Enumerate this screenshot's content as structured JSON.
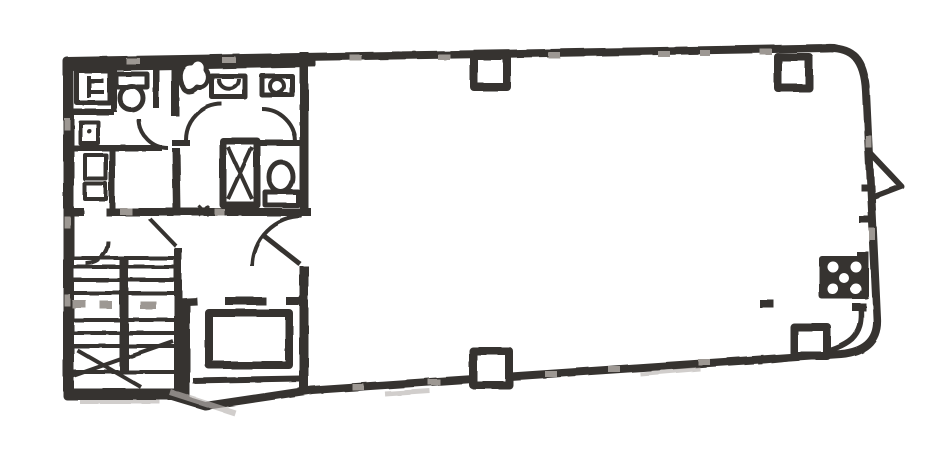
{
  "document": {
    "kind": "scanned architectural floor plan",
    "aria_label": "Scanned building floor plan drawing"
  },
  "colors": {
    "paper": "#ffffff",
    "ink": "#3b3835",
    "ink-soft": "#6b6661",
    "tick": "#9b9692",
    "smudge": "#b5b1ad"
  },
  "plan": {
    "service_core": {
      "washroom_1": {
        "name": "washroom-left",
        "fixtures": [
          "wash-basin-unit",
          "toilet",
          "small-sink",
          "shelf-box",
          "shelf-box"
        ]
      },
      "washroom_2": {
        "name": "washroom-center",
        "fixtures": [
          "sink",
          "sink",
          "pipe-shaft-x",
          "toilet",
          "door-swing",
          "door-swing",
          "column-blob"
        ]
      },
      "stairwell": {
        "name": "stairwell",
        "fixtures": [
          "treads-upper-flight",
          "treads-lower-flight",
          "center-divider",
          "break-diagonals",
          "door-swing"
        ]
      },
      "elevator": {
        "name": "elevator-shaft",
        "fixtures": [
          "elevator-cab",
          "door-openings"
        ]
      },
      "hallway": {
        "name": "hallway",
        "fixtures": [
          "door-swing"
        ]
      }
    },
    "main_area": {
      "name": "open-floor-area",
      "fixtures": [
        "column",
        "column",
        "column",
        "column",
        "service-unit-with-ports",
        "door-marker-triangle",
        "wall-joint-ticks"
      ]
    }
  }
}
